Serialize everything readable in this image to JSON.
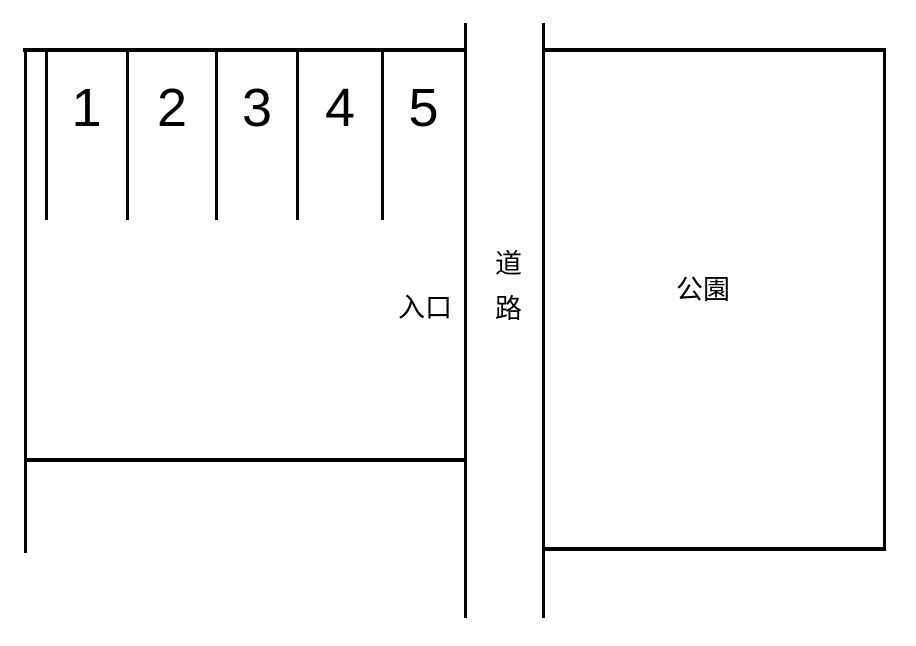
{
  "diagram": {
    "type": "parking-lot-map",
    "parking_lot": {
      "space_numbers": [
        "1",
        "2",
        "3",
        "4",
        "5"
      ],
      "entrance_label": "入口"
    },
    "road": {
      "label": "道路",
      "orientation": "vertical"
    },
    "park": {
      "label": "公園"
    },
    "colors": {
      "line": "#000000",
      "text": "#000000",
      "background": "#ffffff"
    }
  }
}
